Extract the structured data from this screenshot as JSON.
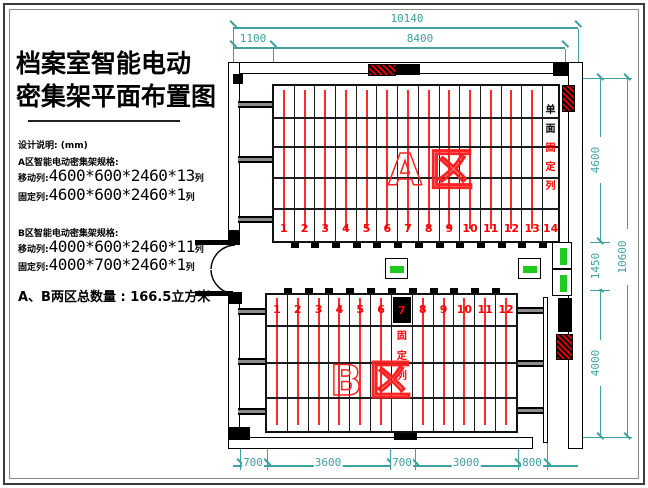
{
  "panel": {
    "title_line1": "档案室智能电动",
    "title_line2": "密集架平面布置图",
    "design_note": "设计说明: (mm)",
    "section_a": {
      "heading": "A区智能电动密集架规格:",
      "rows": [
        {
          "label": "移动列:",
          "value": "4600*600*2460*13",
          "suffix": "列"
        },
        {
          "label": "固定列:",
          "value": "4600*600*2460*1",
          "suffix": "列"
        }
      ]
    },
    "section_b": {
      "heading": "B区智能电动密集架规格:",
      "rows": [
        {
          "label": "移动列:",
          "value": "4000*600*2460*11",
          "suffix": "列"
        },
        {
          "label": "固定列:",
          "value": "4000*700*2460*1",
          "suffix": "列"
        }
      ]
    },
    "total": "A、B两区总数量 : 166.5立方米"
  },
  "dims": {
    "top_total": "10140",
    "top_left": "1100",
    "top_right": "8400",
    "right_a": "4600",
    "right_mid": "1450",
    "right_b": "4000",
    "right_total": "10600",
    "bottom": [
      "700",
      "3600",
      "700",
      "3000",
      "800"
    ]
  },
  "zoneA": {
    "label": "A区",
    "numbers": [
      "1",
      "2",
      "3",
      "4",
      "5",
      "6",
      "7",
      "8",
      "9",
      "10",
      "11",
      "12",
      "13",
      "14"
    ],
    "fixed_top": "单面",
    "fixed_bottom": "固定列"
  },
  "zoneB": {
    "label": "B区",
    "numbers": [
      "1",
      "2",
      "3",
      "4",
      "5",
      "6",
      "7",
      "8",
      "9",
      "10",
      "11",
      "12"
    ],
    "fixed_index": 7,
    "fixed_note": "固定列"
  },
  "colors": {
    "dimension": "#3fa0a0",
    "rail_red": "#ff2a2a",
    "indicator_green": "#1ecb1e"
  }
}
